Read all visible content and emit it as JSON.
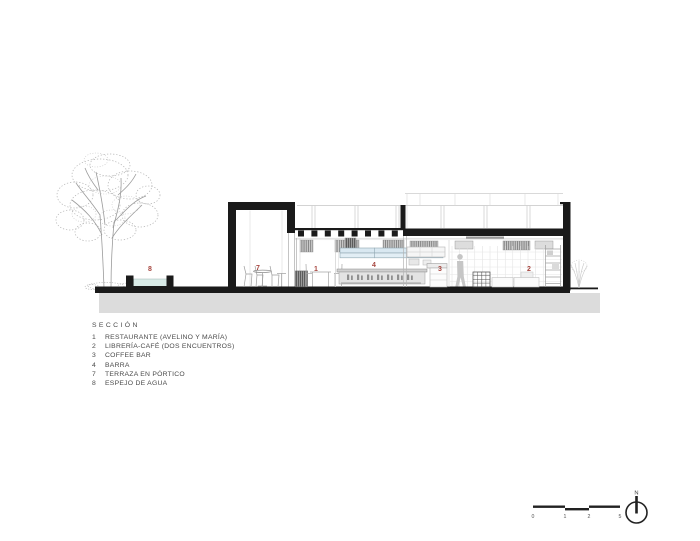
{
  "drawing": {
    "title": "SECCIÓN",
    "legend": [
      {
        "num": "1",
        "label": "RESTAURANTE (AVELINO Y MARÍA)"
      },
      {
        "num": "2",
        "label": "LIBRERÍA-CAFÉ (DOS ENCUENTROS)"
      },
      {
        "num": "3",
        "label": "COFFEE BAR"
      },
      {
        "num": "4",
        "label": "BARRA"
      },
      {
        "num": "7",
        "label": "TERRAZA EN PÓRTICO"
      },
      {
        "num": "8",
        "label": "ESPEJO DE AGUA"
      }
    ],
    "markers": {
      "restaurante": "1",
      "libreria": "2",
      "coffee_bar": "3",
      "barra": "4",
      "terraza": "7",
      "espejo": "8"
    },
    "colors": {
      "marker_red": "#a6453e",
      "water_blue": "#d9ebe7",
      "glass_blue": "#d9e8f1",
      "ink_black": "#1a1a1a",
      "subsoil_gray": "#dcdcdc",
      "legend_text": "#4a4a4a"
    }
  },
  "scale_bar": {
    "ticks": [
      "0",
      "1",
      "2",
      "5"
    ]
  },
  "north": {
    "label": "N"
  }
}
